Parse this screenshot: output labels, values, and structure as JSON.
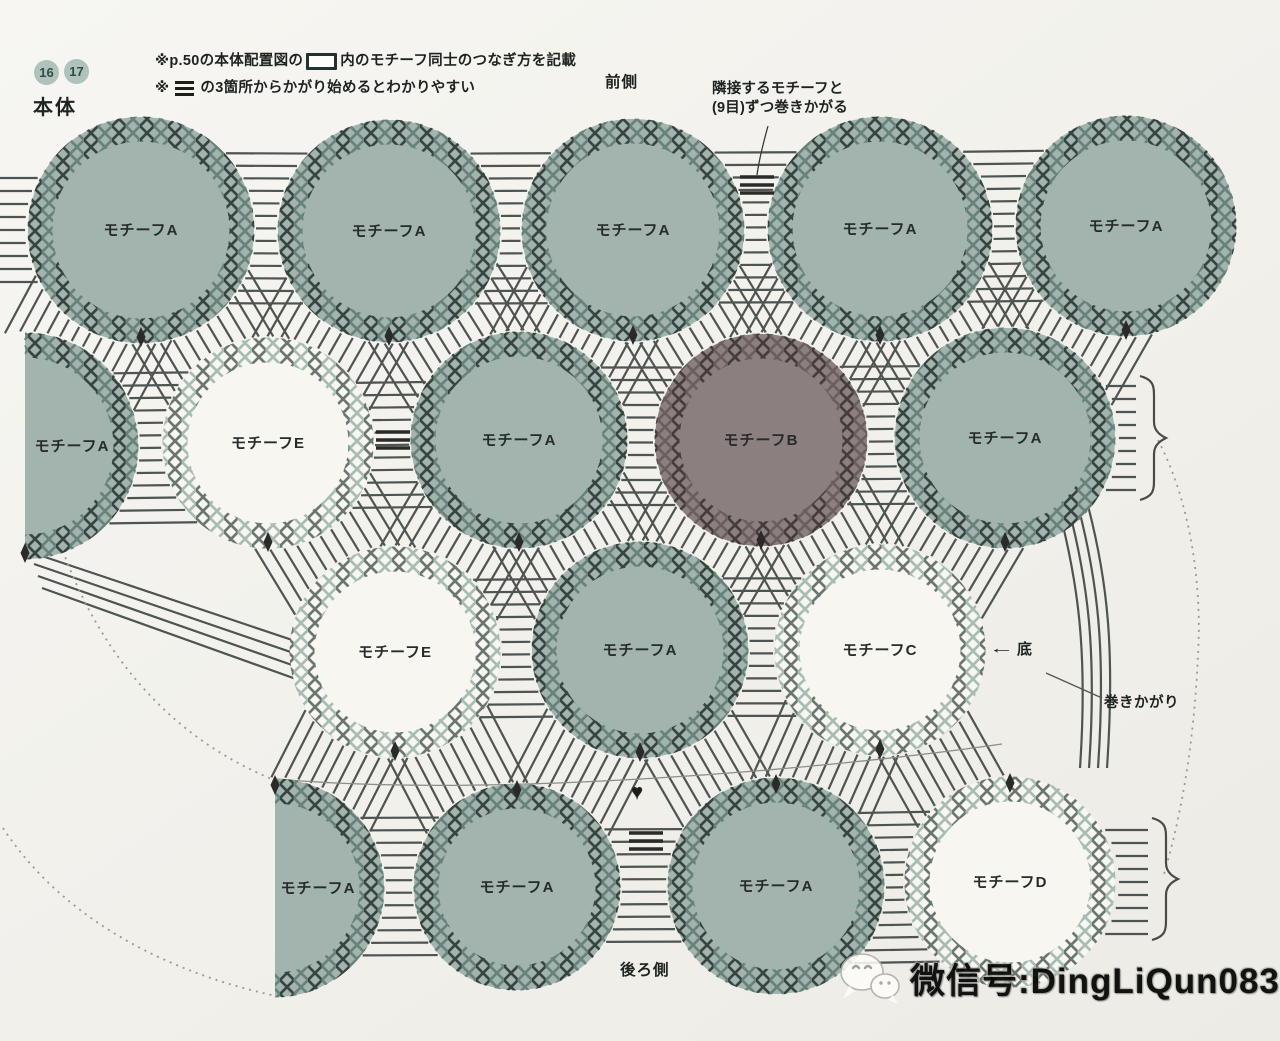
{
  "header": {
    "badges": [
      "16",
      "17"
    ],
    "title": "本体",
    "note1_pre": "※p.50の本体配置図の",
    "note1_post": "内のモチーフ同士のつなぎ方を記載",
    "note2_pre": "※",
    "note2_post": "の3箇所からかがり始めるとわかりやすい"
  },
  "labels": {
    "front": "前側",
    "back": "後ろ側",
    "adjacent_line1": "隣接するモチーフと",
    "adjacent_line2": "(9目)ずつ巻きかがる",
    "bottom_arrow": "←",
    "bottom_text": "底",
    "whip": "巻きかがり",
    "heart": "♥"
  },
  "watermark": {
    "text": "微信号:DingLiQun0830"
  },
  "colors": {
    "background": "#f2f1ec",
    "line": "#4e5451",
    "dotted": "#9a9a92",
    "text": "#1d2320",
    "badge_fill": "#afc2bb",
    "badge_text": "#2f4d46",
    "marker": "#2a2a28",
    "motif_a_fill": "#a3b3ae",
    "motif_b_fill": "#8c7f80",
    "motif_white_fill": "#f7f6f1",
    "ring_a_dark": "#374542",
    "ring_a_light": "#67827b",
    "ring_w_dark": "#6b7671",
    "ring_w_light": "#a7bcb2",
    "ring_b_dark": "#443d3c",
    "ring_b_light": "#6b5f5e"
  },
  "diagram": {
    "types": {
      "a": {
        "fill": "motif_a_fill",
        "dark": "ring_a_dark",
        "light": "ring_a_light"
      },
      "w": {
        "fill": "motif_white_fill",
        "dark": "ring_w_dark",
        "light": "ring_w_light"
      },
      "b": {
        "fill": "motif_b_fill",
        "dark": "ring_b_dark",
        "light": "ring_b_light"
      }
    },
    "motifs": [
      {
        "label": "モチーフA",
        "x": 141,
        "y": 230,
        "r": 113,
        "t": "a",
        "m": "b"
      },
      {
        "label": "モチーフA",
        "x": 389,
        "y": 231,
        "r": 111,
        "t": "a",
        "m": "b"
      },
      {
        "label": "モチーフA",
        "x": 633,
        "y": 230,
        "r": 111,
        "t": "a",
        "m": "b"
      },
      {
        "label": "モチーフA",
        "x": 880,
        "y": 229,
        "r": 112,
        "t": "a",
        "m": "b"
      },
      {
        "label": "モチーフA",
        "x": 1126,
        "y": 226,
        "r": 110,
        "t": "a",
        "m": "b"
      },
      {
        "label": "モチーフA",
        "x": 25,
        "y": 446,
        "r": 113,
        "t": "a",
        "m": "b",
        "clip": 25,
        "dx": 47
      },
      {
        "label": "モチーフE",
        "x": 268,
        "y": 443,
        "r": 105,
        "t": "w",
        "m": "b"
      },
      {
        "label": "モチーフA",
        "x": 519,
        "y": 440,
        "r": 108,
        "t": "a",
        "m": "b"
      },
      {
        "label": "モチーフB",
        "x": 761,
        "y": 440,
        "r": 106,
        "t": "b",
        "m": "b"
      },
      {
        "label": "モチーフA",
        "x": 1005,
        "y": 438,
        "r": 110,
        "t": "a",
        "m": "b"
      },
      {
        "label": "モチーフE",
        "x": 395,
        "y": 652,
        "r": 105,
        "t": "w",
        "m": "b"
      },
      {
        "label": "モチーフA",
        "x": 640,
        "y": 650,
        "r": 108,
        "t": "a",
        "m": "b"
      },
      {
        "label": "モチーフC",
        "x": 880,
        "y": 650,
        "r": 105,
        "t": "w",
        "m": "b"
      },
      {
        "label": "モチーフA",
        "x": 275,
        "y": 888,
        "r": 109,
        "t": "a",
        "m": "t",
        "clip": 275,
        "dx": 43
      },
      {
        "label": "モチーフA",
        "x": 517,
        "y": 887,
        "r": 103,
        "t": "a",
        "m": "t"
      },
      {
        "label": "モチーフA",
        "x": 776,
        "y": 886,
        "r": 108,
        "t": "a",
        "m": "t"
      },
      {
        "label": "モチーフD",
        "x": 1010,
        "y": 882,
        "r": 105,
        "t": "w",
        "m": "t"
      }
    ],
    "connections": [
      [
        0,
        1
      ],
      [
        1,
        2
      ],
      [
        2,
        3
      ],
      [
        3,
        4
      ],
      [
        5,
        6
      ],
      [
        6,
        7
      ],
      [
        7,
        8
      ],
      [
        8,
        9
      ],
      [
        10,
        11
      ],
      [
        11,
        12
      ],
      [
        13,
        14
      ],
      [
        14,
        15
      ],
      [
        15,
        16
      ],
      [
        0,
        5
      ],
      [
        0,
        6
      ],
      [
        1,
        6
      ],
      [
        1,
        7
      ],
      [
        2,
        7
      ],
      [
        2,
        8
      ],
      [
        3,
        8
      ],
      [
        3,
        9
      ],
      [
        4,
        9
      ],
      [
        6,
        10
      ],
      [
        7,
        10
      ],
      [
        7,
        11
      ],
      [
        8,
        11
      ],
      [
        8,
        12
      ],
      [
        9,
        12
      ],
      [
        10,
        13
      ],
      [
        10,
        14
      ],
      [
        11,
        14
      ],
      [
        11,
        15
      ],
      [
        12,
        15
      ],
      [
        12,
        16
      ]
    ]
  }
}
